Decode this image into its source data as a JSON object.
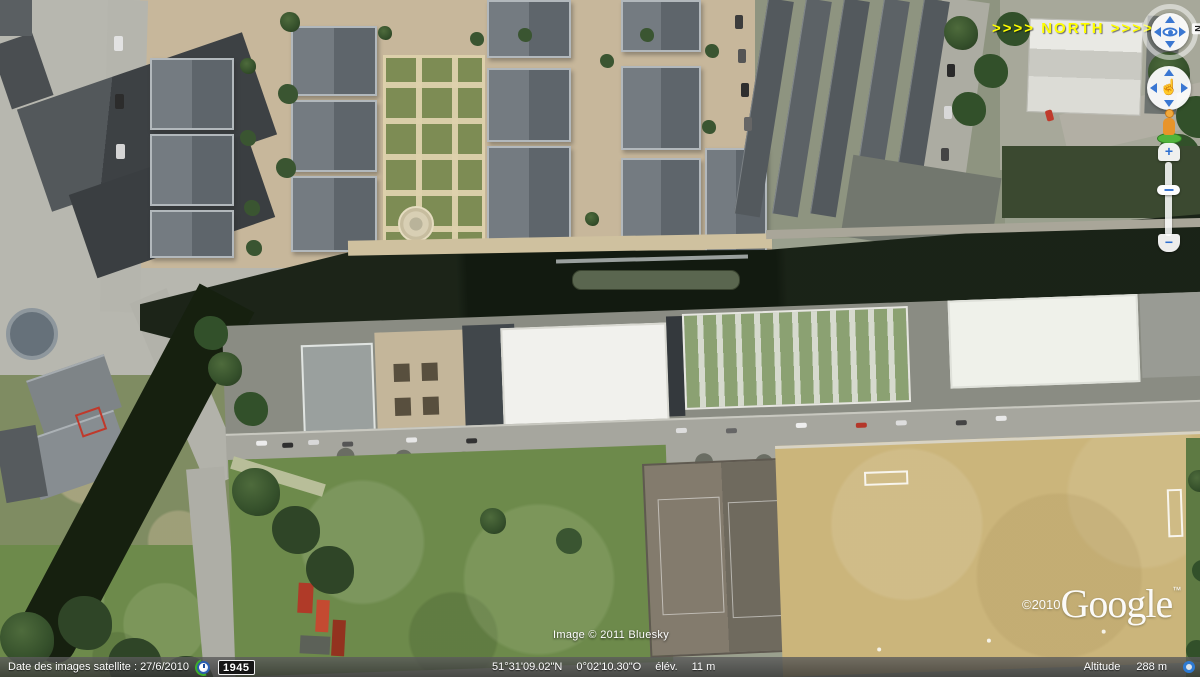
{
  "overlay": {
    "north_label": ">>>> NORTH >>>>",
    "imagery_credit": "Image © 2011 Bluesky",
    "watermark_copyright": "©2010",
    "watermark_brand": "Google",
    "watermark_tm": "™"
  },
  "nav": {
    "north_letter": "N",
    "zoom_in": "+",
    "zoom_out": "−",
    "hand_glyph": "☝"
  },
  "status_bar": {
    "imagery_date": "Date des images satellite : 27/6/2010",
    "time_badge": "1945",
    "latitude": "51°31'09.02\"N",
    "longitude": "0°02'10.30\"O",
    "elevation_label": "élév.",
    "elevation_value": "11 m",
    "altitude_label": "Altitude",
    "altitude_value": "288 m"
  },
  "colors": {
    "north_label": "#ffff00",
    "nav_accent_blue": "#3a77d2",
    "pegman_orange": "#e8942a",
    "pegman_base_green": "#52b43c",
    "status_bar_text": "#ffffff",
    "time_badge_bg": "#161616",
    "canal_water": "#121a10",
    "sports_pitch_tan": "#cbb57b",
    "field_green": "#6d8a4b"
  }
}
